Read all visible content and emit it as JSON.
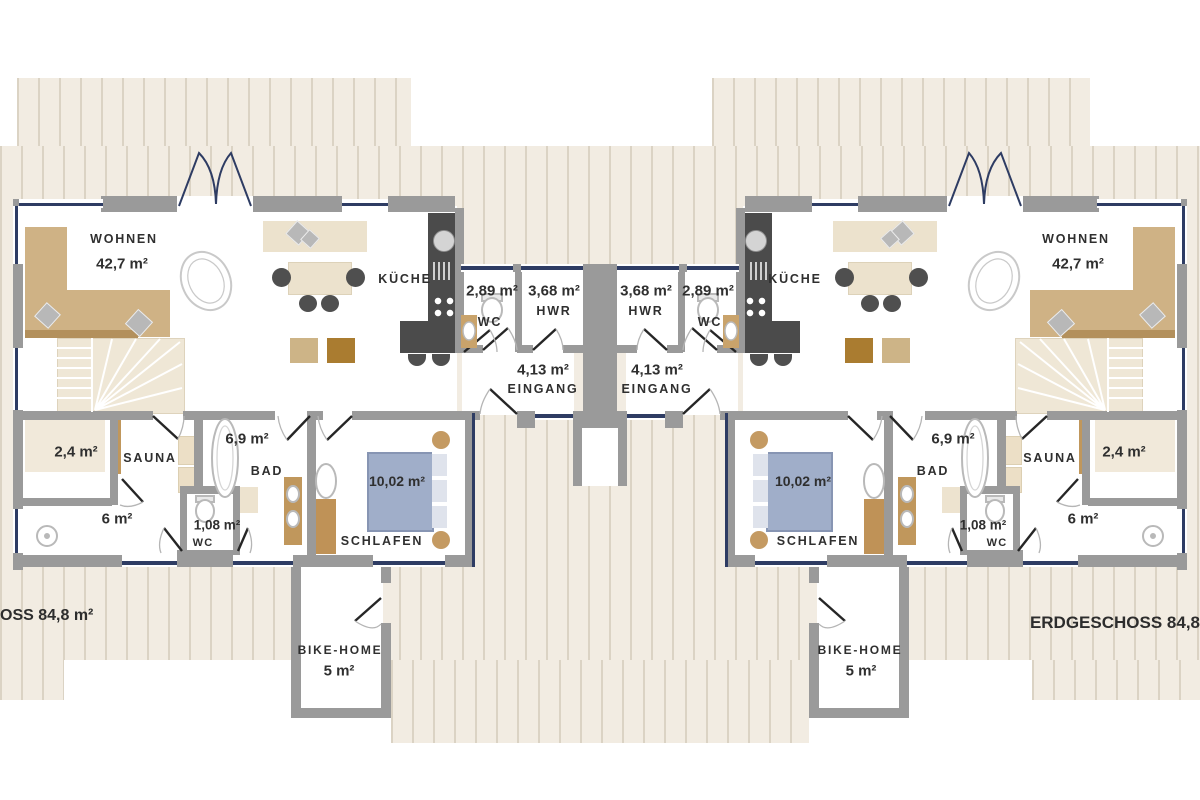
{
  "floor_plan": {
    "label_left_edge": "OSS 84,8 m²",
    "label_right_edge": "ERDGESCHOSS 84,8",
    "unit": {
      "living_name": "WOHNEN",
      "living_area": "42,7 m²",
      "kitchen_name": "KÜCHE",
      "wc_area": "2,89 m²",
      "wc_name": "WC",
      "utility_area": "3,68 m²",
      "utility_name": "HWR",
      "entry_area": "4,13 m²",
      "entry_name": "EINGANG",
      "store_area": "2,4 m²",
      "sauna_name": "SAUNA",
      "bath_area": "6,9 m²",
      "bath_name": "BAD",
      "shower_area": "6 m²",
      "wc2_area": "1,08 m²",
      "wc2_name": "WC",
      "bedroom_area": "10,02 m²",
      "bedroom_name": "SCHLAFEN",
      "bike_name": "BIKE-HOME",
      "bike_area": "5 m²"
    },
    "colors": {
      "deck_base": "#f2ece2",
      "deck_stripe": "#dbd3c4",
      "wall": "#9a9a9a",
      "outline": "#2e3c63",
      "tan": "#cfb285",
      "tan_dark": "#b3905c",
      "cream": "#eadfc8",
      "wood": "#aa7c30",
      "kdark": "#4b4b4b",
      "bed": "#a0aec9",
      "txt": "#2f2f2f"
    }
  }
}
